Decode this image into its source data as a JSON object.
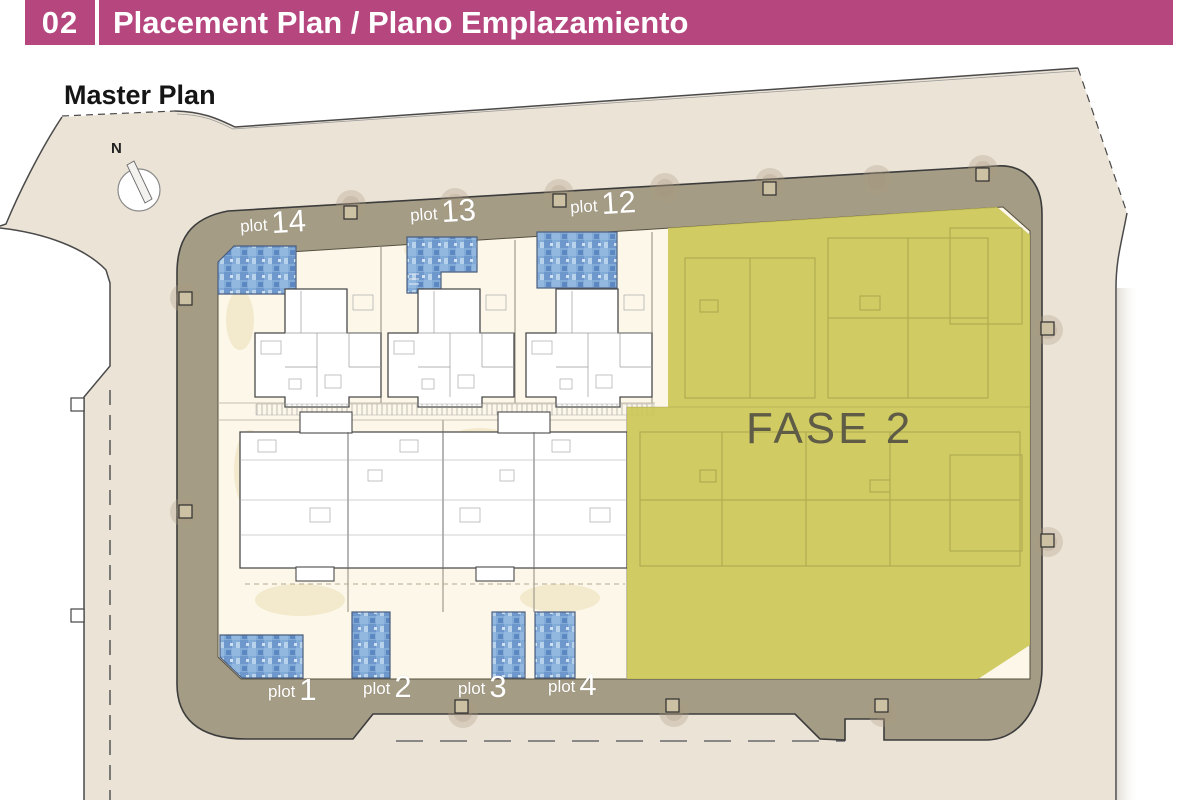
{
  "header": {
    "number": "02",
    "title": "Placement Plan / Plano Emplazamiento"
  },
  "plan": {
    "title": "Master Plan",
    "north_label": "N",
    "phase_label": "FASE 2"
  },
  "plots": {
    "top": [
      {
        "word": "plot",
        "num": "14"
      },
      {
        "word": "plot",
        "num": "13"
      },
      {
        "word": "plot",
        "num": "12"
      }
    ],
    "bottom": [
      {
        "word": "plot",
        "num": "1"
      },
      {
        "word": "plot",
        "num": "2"
      },
      {
        "word": "plot",
        "num": "3"
      },
      {
        "word": "plot",
        "num": "4"
      }
    ]
  },
  "colors": {
    "accent": "#b5477e",
    "road": "#a49c85",
    "parcel": "#ebe3d6",
    "courtyard": "#fcf7e9",
    "phase2": "#cbc553",
    "pool": "#83abd8",
    "phase_text": "#5e5b47"
  }
}
